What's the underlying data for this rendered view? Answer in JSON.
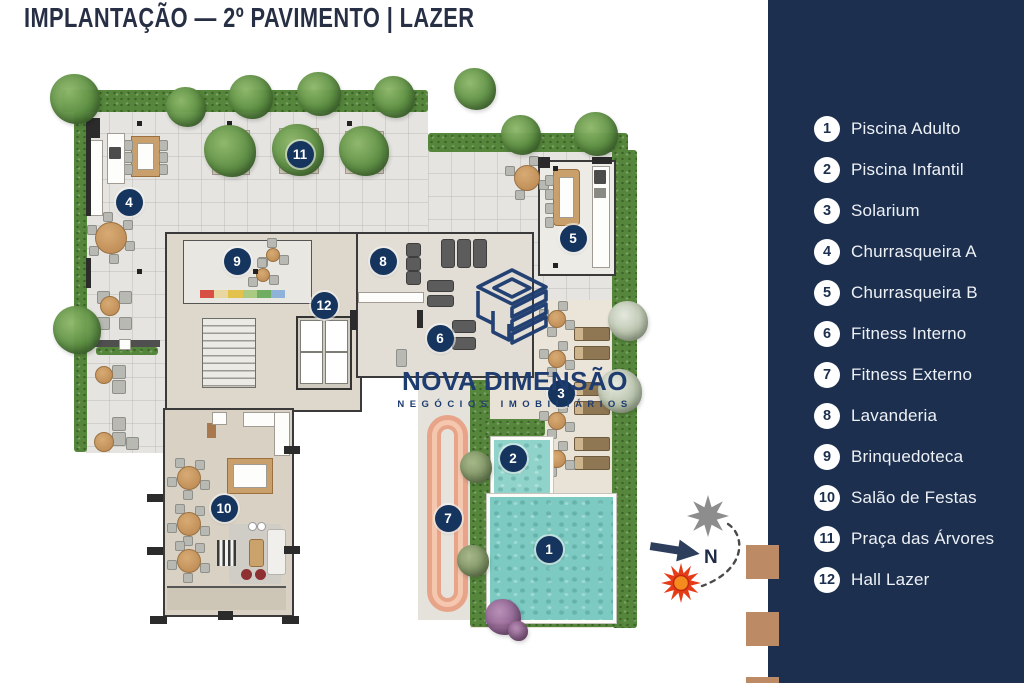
{
  "title": "IMPLANTAÇÃO — 2º PAVIMENTO | LAZER",
  "watermark": {
    "brand": "NOVA DIMENSÃO",
    "tagline": "NEGÓCIOS IMOBILIÁRIOS"
  },
  "compass": {
    "north_label": "N"
  },
  "legend": {
    "items": [
      {
        "num": "1",
        "label": "Piscina Adulto"
      },
      {
        "num": "2",
        "label": "Piscina Infantil"
      },
      {
        "num": "3",
        "label": "Solarium"
      },
      {
        "num": "4",
        "label": "Churrasqueira A"
      },
      {
        "num": "5",
        "label": "Churrasqueira B"
      },
      {
        "num": "6",
        "label": "Fitness Interno"
      },
      {
        "num": "7",
        "label": "Fitness Externo"
      },
      {
        "num": "8",
        "label": "Lavanderia"
      },
      {
        "num": "9",
        "label": "Brinquedoteca"
      },
      {
        "num": "10",
        "label": "Salão de Festas"
      },
      {
        "num": "11",
        "label": "Praça das Árvores"
      },
      {
        "num": "12",
        "label": "Hall Lazer"
      }
    ]
  },
  "plan": {
    "markers": [
      {
        "num": "1",
        "x": 549,
        "y": 549
      },
      {
        "num": "2",
        "x": 513,
        "y": 458
      },
      {
        "num": "3",
        "x": 561,
        "y": 393
      },
      {
        "num": "4",
        "x": 129,
        "y": 202
      },
      {
        "num": "5",
        "x": 573,
        "y": 238
      },
      {
        "num": "6",
        "x": 440,
        "y": 338
      },
      {
        "num": "7",
        "x": 448,
        "y": 518
      },
      {
        "num": "8",
        "x": 383,
        "y": 261
      },
      {
        "num": "9",
        "x": 237,
        "y": 261
      },
      {
        "num": "10",
        "x": 224,
        "y": 508
      },
      {
        "num": "11",
        "x": 300,
        "y": 154
      },
      {
        "num": "12",
        "x": 324,
        "y": 305
      }
    ]
  },
  "colors": {
    "panel_navy": "#1c2f4e",
    "badge_navy": "#16355e",
    "brand_navy": "#1e3c70",
    "pool_teal": "#7ccac2",
    "track_salmon": "#e7a489",
    "hedge_green": "#55863b",
    "sun_red": "#e63b17",
    "star_gray": "#8d8d8d",
    "wood_brown": "#bf9161",
    "square_brown": "#bc8a64"
  }
}
